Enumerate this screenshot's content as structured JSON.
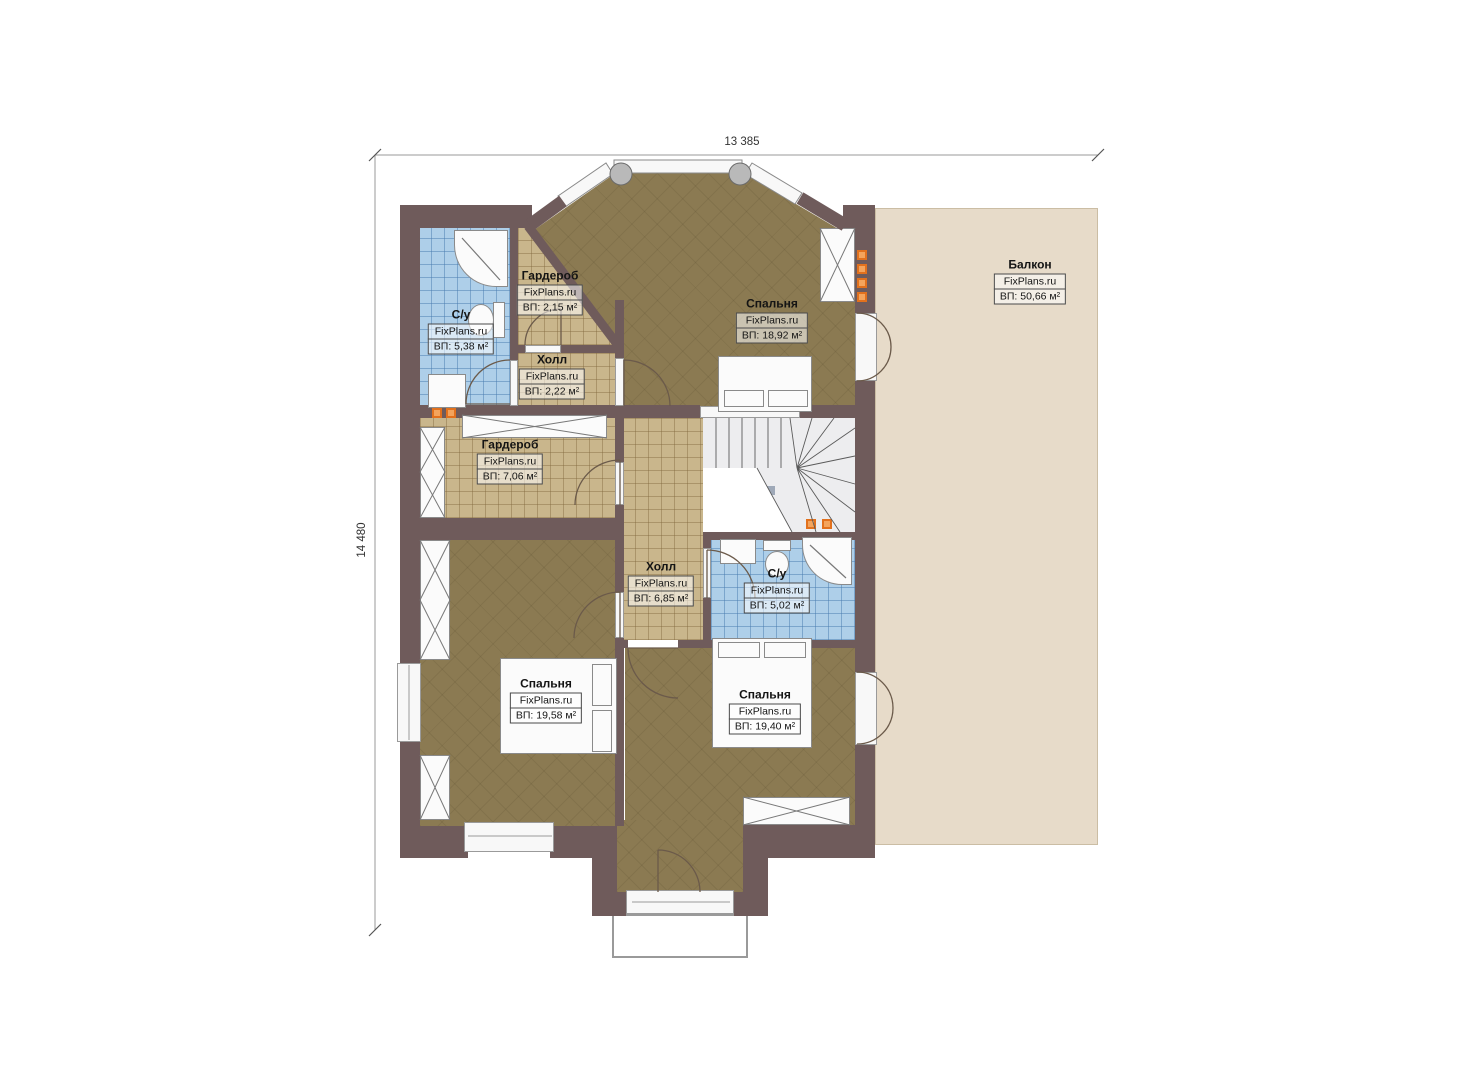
{
  "plan": {
    "type": "second-floor-plan",
    "brand": "FixPlans.ru"
  },
  "dimensions": {
    "top": "13 385",
    "left": "14 480"
  },
  "rooms": [
    {
      "key": "balcony",
      "name": "Балкон",
      "brand": "FixPlans.ru",
      "area": "ВП: 50,66 м²"
    },
    {
      "key": "bedroom-top",
      "name": "Спальня",
      "brand": "FixPlans.ru",
      "area": "ВП: 18,92 м²"
    },
    {
      "key": "wardrobe-top",
      "name": "Гардероб",
      "brand": "FixPlans.ru",
      "area": "ВП: 2,15 м²"
    },
    {
      "key": "bathroom-top",
      "name": "С/у",
      "brand": "FixPlans.ru",
      "area": "ВП: 5,38 м²"
    },
    {
      "key": "hall-small",
      "name": "Холл",
      "brand": "FixPlans.ru",
      "area": "ВП: 2,22 м²"
    },
    {
      "key": "wardrobe-mid",
      "name": "Гардероб",
      "brand": "FixPlans.ru",
      "area": "ВП: 7,06 м²"
    },
    {
      "key": "hall-mid",
      "name": "Холл",
      "brand": "FixPlans.ru",
      "area": "ВП: 6,85 м²"
    },
    {
      "key": "bathroom-mid",
      "name": "С/у",
      "brand": "FixPlans.ru",
      "area": "ВП: 5,02 м²"
    },
    {
      "key": "bedroom-left",
      "name": "Спальня",
      "brand": "FixPlans.ru",
      "area": "ВП: 19,58 м²"
    },
    {
      "key": "bedroom-right",
      "name": "Спальня",
      "brand": "FixPlans.ru",
      "area": "ВП: 19,40 м²"
    }
  ],
  "colors": {
    "wall": "#6f5b5b",
    "floor_wood": "#8b7a52",
    "tile_tan": "#c9b68c",
    "tile_blue": "#aecfe9",
    "balcony": "#e7dbc9",
    "stairs": "#ededef",
    "vent_orange": "#e2711d",
    "fixture_white": "#fbfbfb"
  }
}
